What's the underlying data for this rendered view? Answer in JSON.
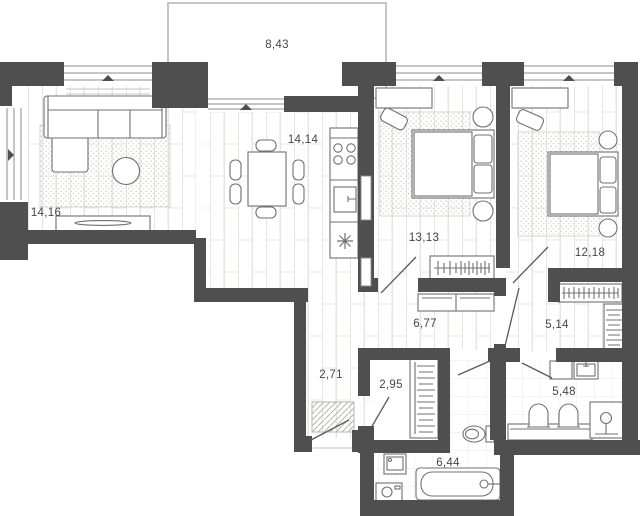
{
  "plan": {
    "type": "apartment-floor-plan",
    "units": "m2",
    "rooms": [
      {
        "id": "balcony",
        "area": "8,43"
      },
      {
        "id": "living-room",
        "area": "14,16"
      },
      {
        "id": "kitchen-dining",
        "area": "14,14"
      },
      {
        "id": "bedroom-1",
        "area": "13,13"
      },
      {
        "id": "bedroom-2",
        "area": "12,18"
      },
      {
        "id": "hallway",
        "area": "6,77"
      },
      {
        "id": "wardrobe-hall",
        "area": "5,14"
      },
      {
        "id": "entry-hall",
        "area": "2,71"
      },
      {
        "id": "closet",
        "area": "2,95"
      },
      {
        "id": "bathroom-master",
        "area": "5,48"
      },
      {
        "id": "bathroom",
        "area": "6,44"
      }
    ],
    "colors": {
      "wall": "#4f4f4f",
      "floor_line": "#e7e4df",
      "tile_line": "#eceae5",
      "furniture_line": "#707070",
      "rug_dot": "#d6d3cd",
      "balcony_outline": "#c8c6c1",
      "text": "#464646",
      "background": "#ffffff"
    }
  }
}
